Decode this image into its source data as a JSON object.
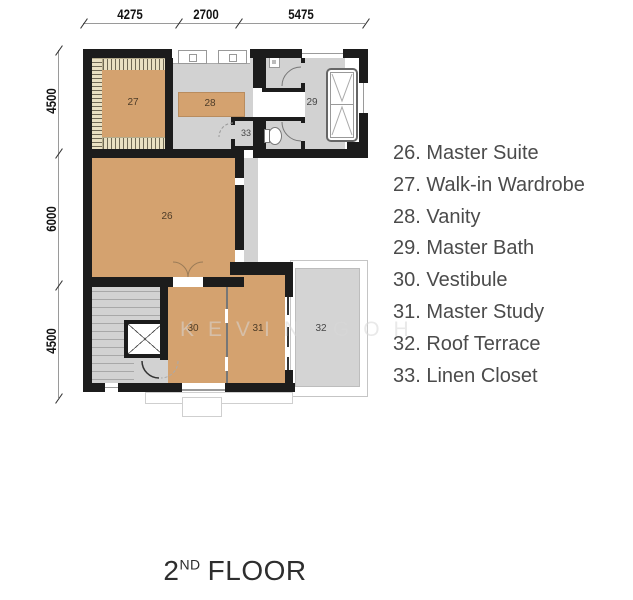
{
  "title": {
    "num": "2",
    "sup": "ND",
    "rest": "FLOOR"
  },
  "legend": {
    "items": [
      "26. Master Suite",
      "27. Walk-in Wardrobe",
      "28. Vanity",
      "29. Master Bath",
      "30. Vestibule",
      "31. Master Study",
      "32. Roof Terrace",
      "33. Linen Closet"
    ]
  },
  "dims": {
    "top": [
      "4275",
      "2700",
      "5475"
    ],
    "left": [
      "4500",
      "6000",
      "4500"
    ]
  },
  "rooms": {
    "r26": "26",
    "r27": "27",
    "r28": "28",
    "r29": "29",
    "r30": "30",
    "r31": "31",
    "r32": "32",
    "r33": "33"
  },
  "watermark": "KEVIN GOH",
  "colors": {
    "floor_tan": "#d4a26f",
    "floor_gray": "#d2d2d2",
    "wardrobe_cream": "#e9e0c2",
    "wall_black": "#1c1c1c",
    "terrace_gray": "#d4d4d4"
  }
}
